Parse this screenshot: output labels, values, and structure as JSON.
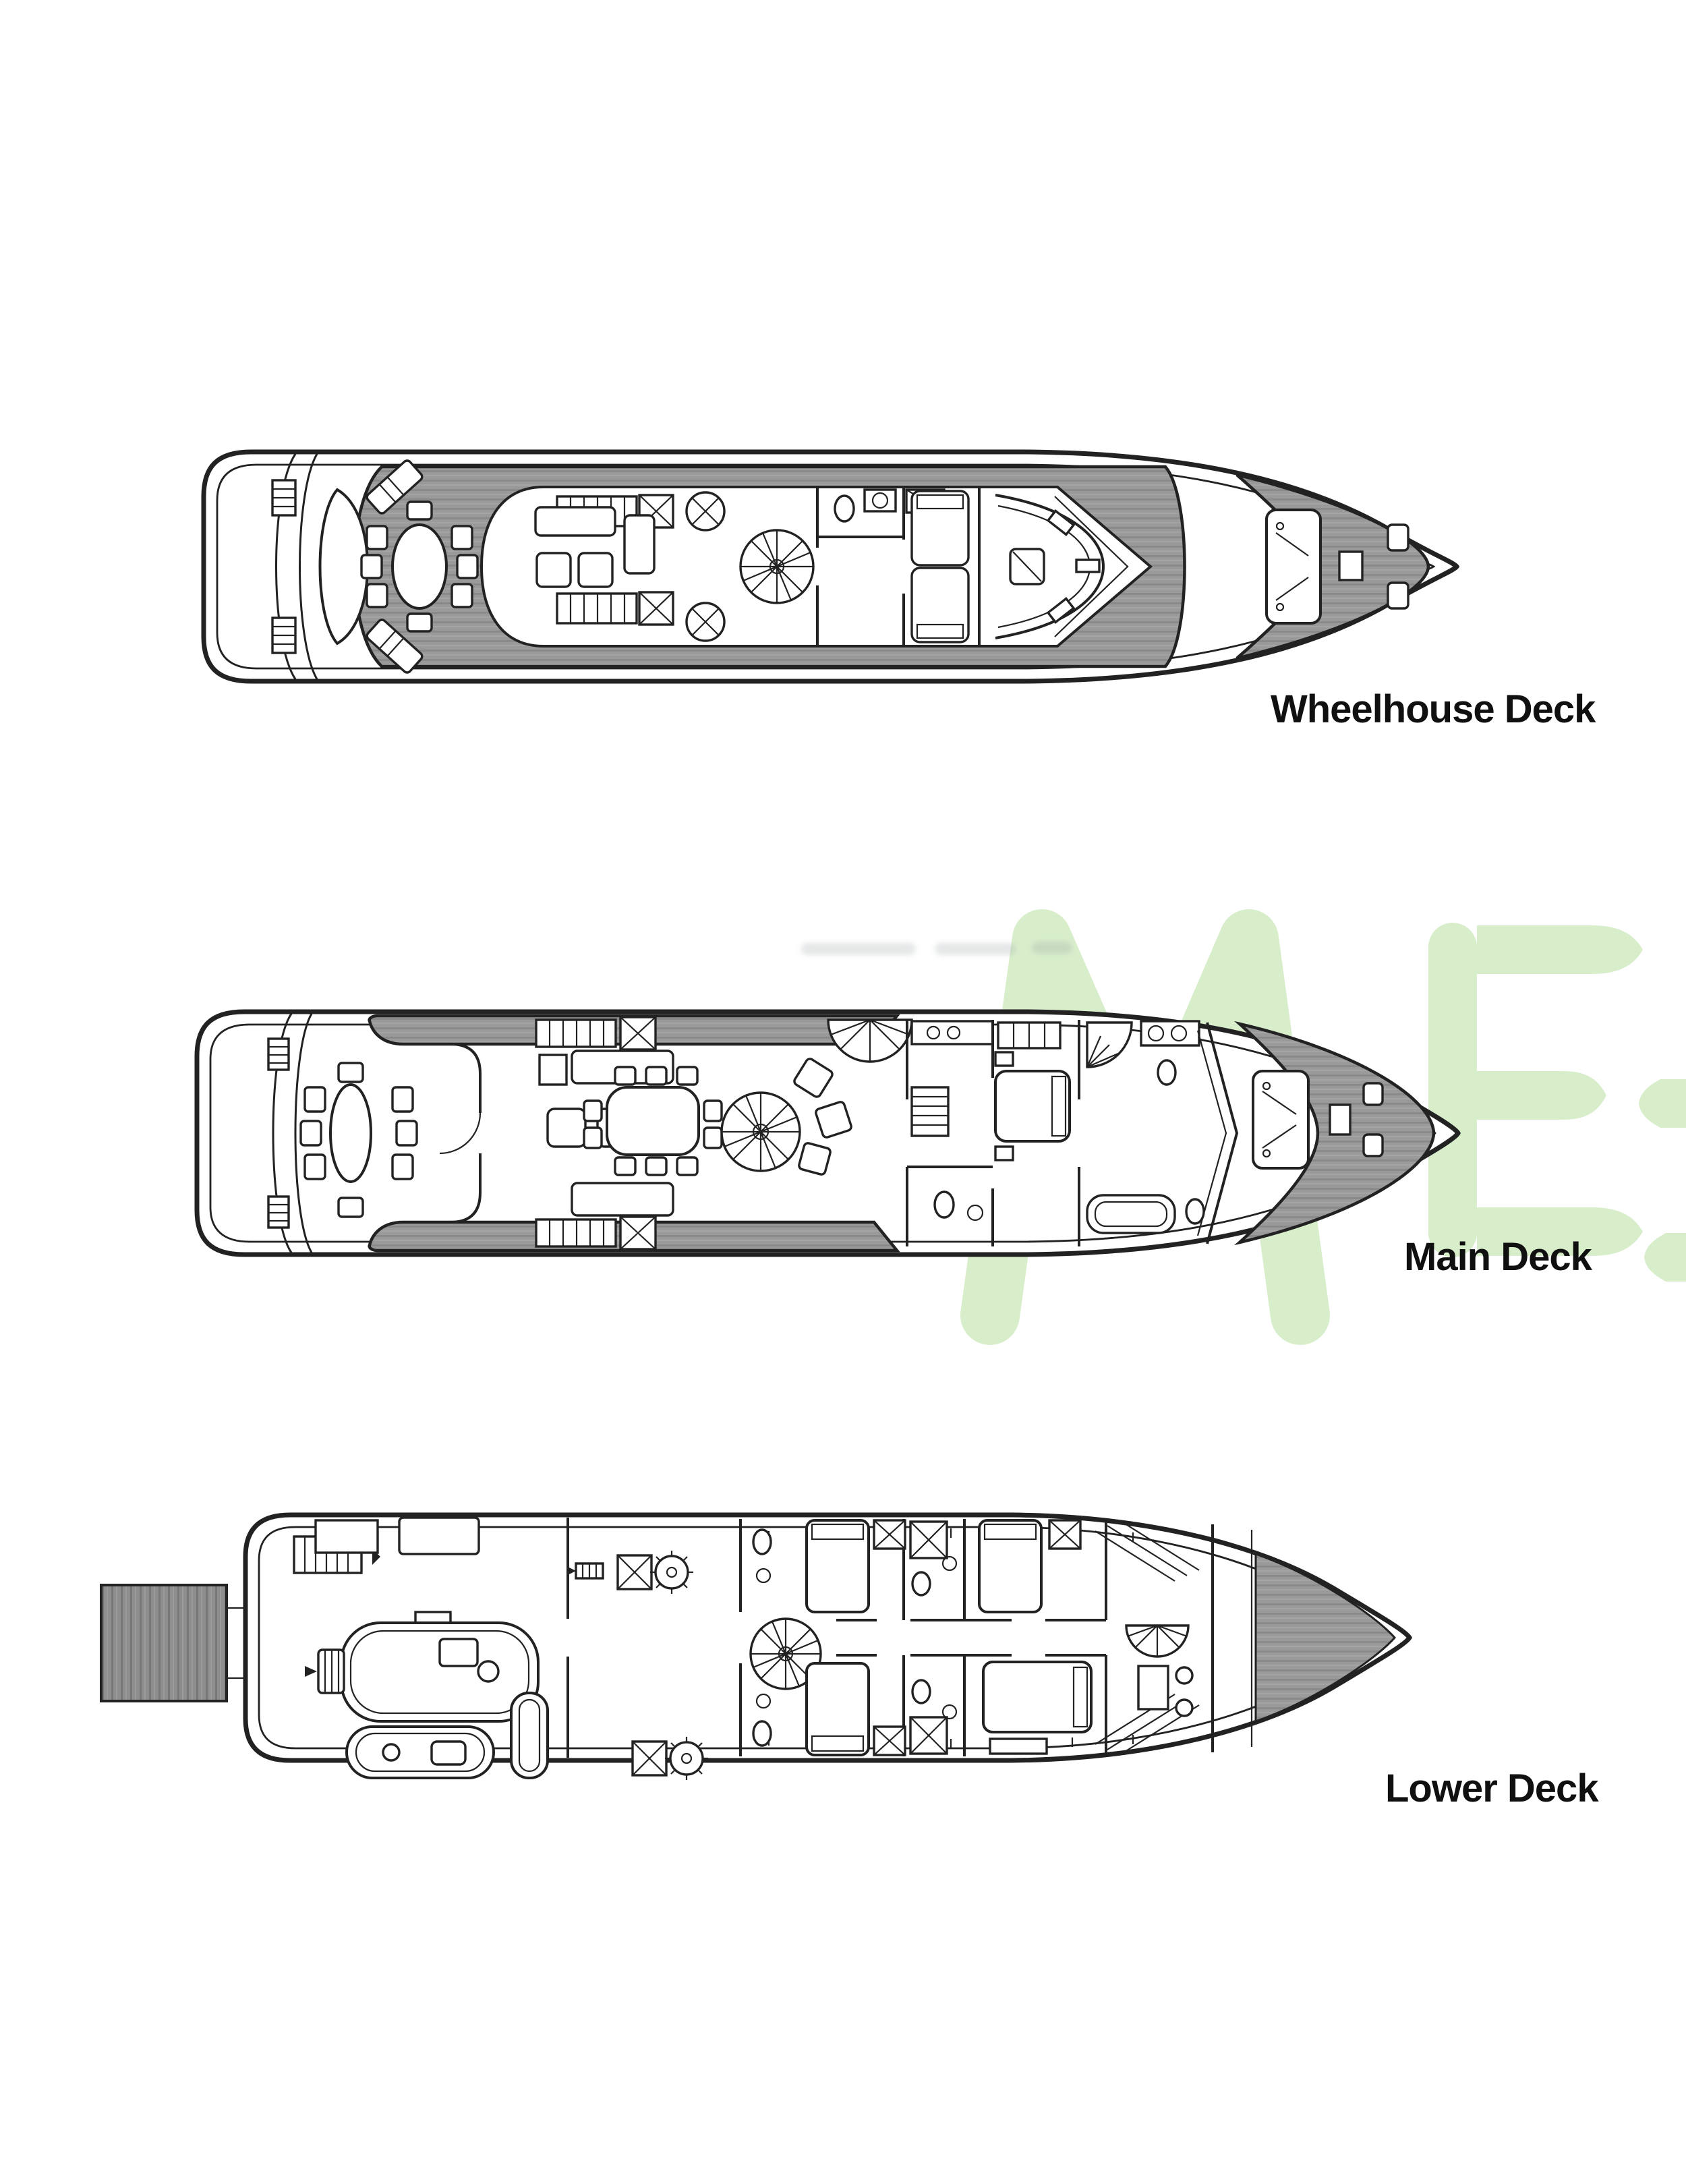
{
  "figure": {
    "type": "yacht-deck-plan",
    "background": "#ffffff"
  },
  "theme": {
    "ink": "#222222",
    "deck_fill": "#9a9a9a",
    "platform_fill": "#8e8e8e",
    "watermark_green": "#d8eecb",
    "label_color": "#101010"
  },
  "decks": [
    {
      "id": "wheelhouse-deck",
      "label": "Wheelhouse Deck"
    },
    {
      "id": "main-deck",
      "label": "Main Deck"
    },
    {
      "id": "lower-deck",
      "label": "Lower Deck"
    }
  ]
}
